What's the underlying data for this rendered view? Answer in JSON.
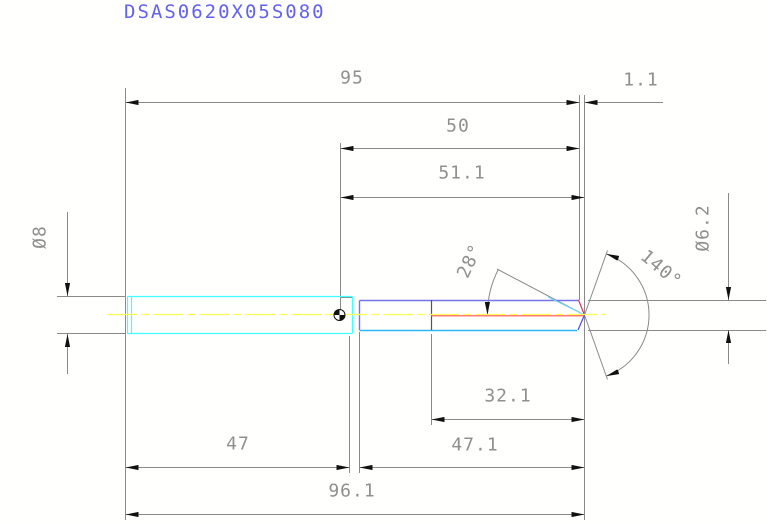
{
  "title": "DSAS0620X05S080",
  "colors": {
    "title_text": "#6262ec",
    "dimension_text": "#8f8f8f",
    "dimension_lines": "#8a8a8a",
    "arrowheads": "#111111",
    "shank_outline": "#40ffff",
    "flute_outline": "#7473e8",
    "flute_bottom_edge": "#2bb8ff",
    "point_flank_edge": "#7adcff",
    "point_top_edge": "#d6336c",
    "point_bottom_edge": "#4c4cdf",
    "centerline": "#ffff55",
    "core_line": "#ff5050"
  },
  "dims": {
    "length_95": "95",
    "point_length_1_1": "1.1",
    "length_50": "50",
    "length_51_1": "51.1",
    "shank_diameter": "Ø8",
    "cutting_diameter": "Ø6.2",
    "relief_angle_28": "28°",
    "point_angle_140": "140°",
    "flute_length_32_1": "32.1",
    "shank_length_47": "47",
    "flute_section_47_1": "47.1",
    "overall_length_96_1": "96.1"
  }
}
